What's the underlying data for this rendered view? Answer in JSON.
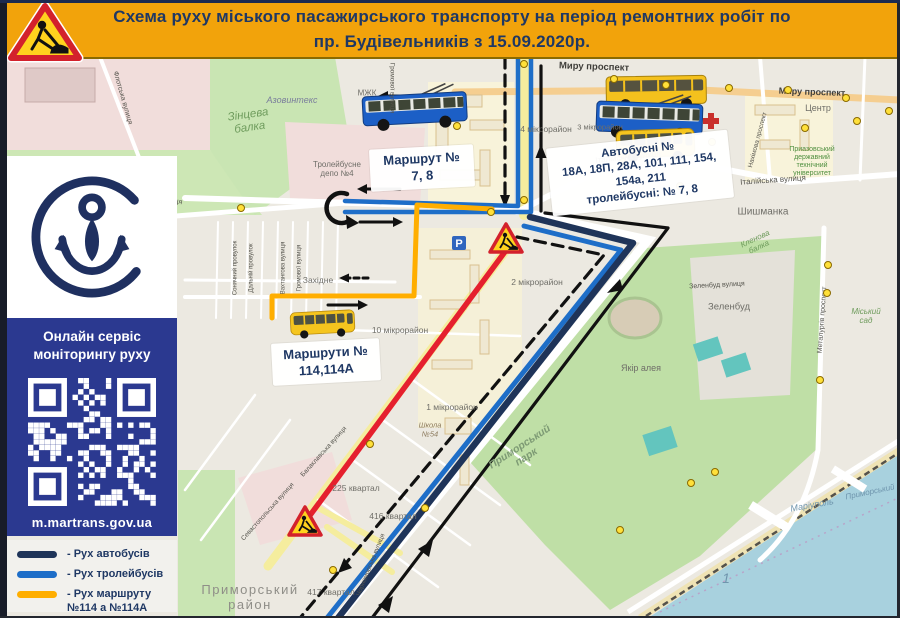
{
  "header": {
    "title_line1": "Схема руху міського пасажирського транспорту на період ремонтних робіт по",
    "title_line2": "пр. Будівельників з 15.09.2020р."
  },
  "sidebar": {
    "service_text": "Онлайн сервіс моніторингу руху",
    "qr_url": "m.martrans.gov.ua",
    "legend": [
      {
        "color": "#1F3459",
        "label": "- Рух автобусів"
      },
      {
        "color": "#1E6EC8",
        "label": "- Рух тролейбусів"
      },
      {
        "color": "#FFAE00",
        "label": "- Рух маршруту\n№114 а №114А"
      }
    ]
  },
  "callouts": {
    "route78": {
      "line1": "Маршрут №",
      "line2": "7, 8"
    },
    "buses": {
      "line1": "Автобусні №",
      "line2": "18А, 18П, 28А, 101, 111, 154,",
      "line3": "154а, 211",
      "line4": "тролейбусні: № 7, 8"
    },
    "route114": {
      "line1": "Маршрути №",
      "line2": "114,114А"
    }
  },
  "colors": {
    "header_bg": "#F2A30B",
    "header_text": "#1F3864",
    "bus_route": "#1F3459",
    "trolleybus_route": "#1E6EC8",
    "route_114": "#FFAE00",
    "closed_section": "#E5202E",
    "info_box": "#2B3990",
    "water": "#A8D1DE",
    "park": "#BFDFA6"
  },
  "map_labels": [
    {
      "t": "Азовинтекс",
      "x": 292,
      "y": 100,
      "r": 0,
      "s": 9,
      "c": "ind"
    },
    {
      "t": "Зінцева\nбалка",
      "x": 249,
      "y": 122,
      "r": -8,
      "s": 11.5,
      "c": "green"
    },
    {
      "t": "МЖК",
      "x": 367,
      "y": 93,
      "r": 0,
      "s": 8,
      "c": "gray"
    },
    {
      "t": "Тролейбусне\nдепо №4",
      "x": 337,
      "y": 169,
      "r": 0,
      "s": 8,
      "c": "gray"
    },
    {
      "t": "Бахчиванджі вулиця",
      "x": 150,
      "y": 196,
      "r": 13,
      "s": 7,
      "c": "street"
    },
    {
      "t": "Флотська вулиця",
      "x": 122,
      "y": 98,
      "r": 74,
      "s": 7,
      "c": "street"
    },
    {
      "t": "Громової вулиця",
      "x": 392,
      "y": 88,
      "r": 90,
      "s": 6.5,
      "c": "street"
    },
    {
      "t": "Миру проспект",
      "x": 594,
      "y": 68,
      "r": 2,
      "s": 9.5,
      "c": "road"
    },
    {
      "t": "Миру проспект",
      "x": 812,
      "y": 92,
      "r": 2,
      "s": 9,
      "c": "road"
    },
    {
      "t": "Центр",
      "x": 818,
      "y": 108,
      "r": 0,
      "s": 9,
      "c": "gray"
    },
    {
      "t": "4 мікрорайон",
      "x": 546,
      "y": 130,
      "r": 0,
      "s": 8.5,
      "c": "gray"
    },
    {
      "t": "3 мікрорайон",
      "x": 600,
      "y": 128,
      "r": 0,
      "s": 7.5,
      "c": "gray"
    },
    {
      "t": "Італійська вулиця",
      "x": 628,
      "y": 157,
      "r": -6,
      "s": 8,
      "c": "street"
    },
    {
      "t": "Італійська вулиця",
      "x": 773,
      "y": 180,
      "r": -4,
      "s": 8,
      "c": "street"
    },
    {
      "t": "Шишманка",
      "x": 763,
      "y": 212,
      "r": 0,
      "s": 10,
      "c": "gray"
    },
    {
      "t": "Приазовський\nдержавний\nтехнічний\nуніверситет",
      "x": 812,
      "y": 162,
      "r": 0,
      "s": 7,
      "c": "uni"
    },
    {
      "t": "2 мікрорайон",
      "x": 537,
      "y": 283,
      "r": 0,
      "s": 8.5,
      "c": "gray"
    },
    {
      "t": "10 мікрорайон",
      "x": 400,
      "y": 331,
      "r": 0,
      "s": 8.5,
      "c": "gray"
    },
    {
      "t": "1 мікрорайон",
      "x": 452,
      "y": 408,
      "r": 0,
      "s": 8.5,
      "c": "gray"
    },
    {
      "t": "Школа\n№54",
      "x": 430,
      "y": 430,
      "r": 0,
      "s": 7.5,
      "c": "school"
    },
    {
      "t": "225 квартал",
      "x": 356,
      "y": 489,
      "r": 0,
      "s": 8.5,
      "c": "gray"
    },
    {
      "t": "416 квартал",
      "x": 393,
      "y": 517,
      "r": 0,
      "s": 8.5,
      "c": "gray"
    },
    {
      "t": "417 квартал",
      "x": 331,
      "y": 593,
      "r": 0,
      "s": 8.5,
      "c": "gray"
    },
    {
      "t": "Приморський\nрайон",
      "x": 250,
      "y": 598,
      "r": 0,
      "s": 13,
      "c": "big"
    },
    {
      "t": "Приморський\nпарк",
      "x": 523,
      "y": 452,
      "r": -33,
      "s": 10.5,
      "c": "parkname"
    },
    {
      "t": "Зеленбуд вулиця",
      "x": 717,
      "y": 286,
      "r": -3,
      "s": 7,
      "c": "street"
    },
    {
      "t": "Зеленбуд",
      "x": 729,
      "y": 308,
      "r": 0,
      "s": 9.5,
      "c": "gray"
    },
    {
      "t": "Якір алея",
      "x": 641,
      "y": 368,
      "r": 0,
      "s": 9,
      "c": "gray"
    },
    {
      "t": "Міський\nсад",
      "x": 866,
      "y": 316,
      "r": 0,
      "s": 8,
      "c": "green"
    },
    {
      "t": "Металургів проспект",
      "x": 823,
      "y": 320,
      "r": -86,
      "s": 7,
      "c": "street"
    },
    {
      "t": "Кленова\nбалка",
      "x": 757,
      "y": 243,
      "r": -25,
      "s": 8,
      "c": "green"
    },
    {
      "t": "Маріуполь",
      "x": 812,
      "y": 505,
      "r": -10,
      "s": 9,
      "c": "water"
    },
    {
      "t": "Приморський",
      "x": 870,
      "y": 492,
      "r": -12,
      "s": 8,
      "c": "water"
    },
    {
      "t": "1",
      "x": 726,
      "y": 578,
      "r": 0,
      "s": 14,
      "c": "water"
    },
    {
      "t": "Західне",
      "x": 318,
      "y": 281,
      "r": 0,
      "s": 8.5,
      "c": "gray"
    },
    {
      "t": "Сонячний провулок",
      "x": 236,
      "y": 268,
      "r": -90,
      "s": 6,
      "c": "street"
    },
    {
      "t": "Дальній провулок",
      "x": 252,
      "y": 268,
      "r": -90,
      "s": 6,
      "c": "street"
    },
    {
      "t": "Вахтангова вулиця",
      "x": 284,
      "y": 268,
      "r": -90,
      "s": 6,
      "c": "street"
    },
    {
      "t": "Громової вулиця",
      "x": 300,
      "y": 268,
      "r": -90,
      "s": 6,
      "c": "street"
    },
    {
      "t": "Чорноморська вулиця",
      "x": 371,
      "y": 565,
      "r": -68,
      "s": 6.5,
      "c": "street"
    },
    {
      "t": "Севастопольська вулиця",
      "x": 268,
      "y": 512,
      "r": -48,
      "s": 6.5,
      "c": "street"
    },
    {
      "t": "Балаклавська вулиця",
      "x": 324,
      "y": 452,
      "r": -48,
      "s": 6.5,
      "c": "street"
    },
    {
      "t": "Нахімова проспект",
      "x": 758,
      "y": 140,
      "r": -75,
      "s": 6.5,
      "c": "street"
    }
  ],
  "stops": [
    [
      524,
      64
    ],
    [
      614,
      79
    ],
    [
      666,
      85
    ],
    [
      729,
      88
    ],
    [
      788,
      90
    ],
    [
      846,
      98
    ],
    [
      857,
      121
    ],
    [
      889,
      111
    ],
    [
      712,
      142
    ],
    [
      623,
      162
    ],
    [
      805,
      128
    ],
    [
      680,
      186
    ],
    [
      524,
      200
    ],
    [
      491,
      212
    ],
    [
      457,
      126
    ],
    [
      828,
      265
    ],
    [
      827,
      293
    ],
    [
      820,
      380
    ],
    [
      691,
      483
    ],
    [
      715,
      472
    ],
    [
      620,
      530
    ],
    [
      370,
      444
    ],
    [
      425,
      508
    ],
    [
      333,
      570
    ],
    [
      241,
      208
    ]
  ]
}
